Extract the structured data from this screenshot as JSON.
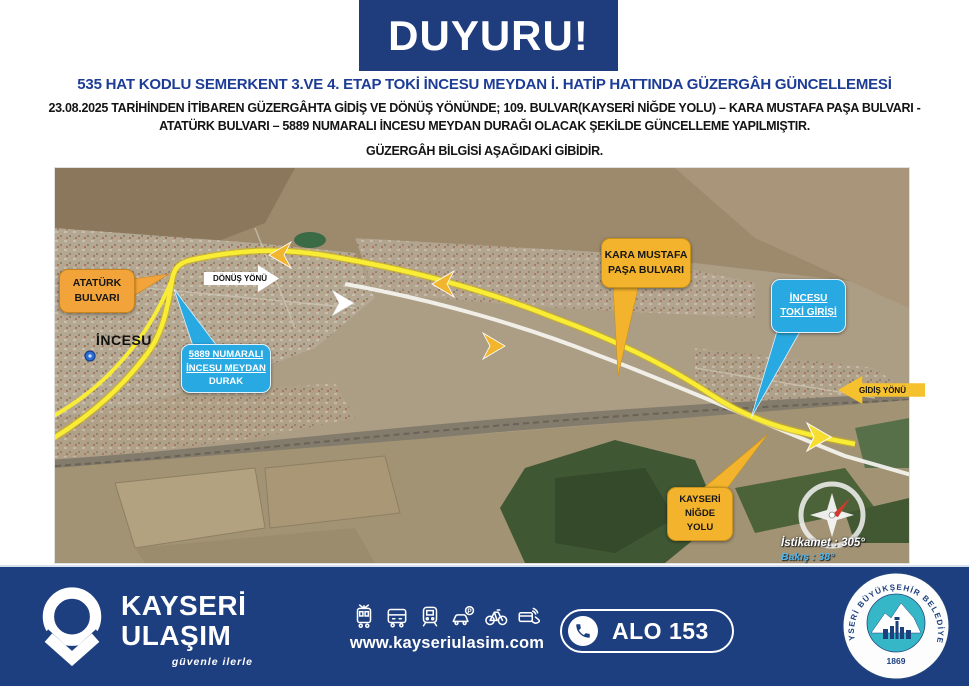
{
  "colors": {
    "primary_blue": "#1F3D7D",
    "title_blue": "#1D3C96",
    "callout_yellow": "#F3B32C",
    "callout_blue": "#29A9E1",
    "route_yellow": "#F8EC35",
    "seal_teal": "#36B7C8"
  },
  "header": {
    "banner": "DUYURU!",
    "title": "535 HAT KODLU SEMERKENT 3.VE 4. ETAP TOKİ İNCESU MEYDAN İ. HATİP HATTINDA GÜZERGÂH GÜNCELLEMESİ"
  },
  "body": {
    "line1": "23.08.2025 TARİHİNDEN İTİBAREN GÜZERGÂHTA GİDİŞ VE DÖNÜŞ YÖNÜNDE; 109. BULVAR(KAYSERİ NİĞDE YOLU) – KARA MUSTAFA PAŞA BULVARI  -",
    "line2": "ATATÜRK BULVARI – 5889 NUMARALI İNCESU MEYDAN DURAĞI OLACAK ŞEKİLDE GÜNCELLEME YAPILMIŞTIR.",
    "line3": "GÜZERGÂH BİLGİSİ AŞAĞIDAKİ GİBİDİR."
  },
  "map": {
    "ataturk": {
      "line1": "ATATÜRK",
      "line2": "BULVARI"
    },
    "donus": {
      "text": "DÖNÜŞ YÖNÜ"
    },
    "incesu": "İNCESU",
    "durak": {
      "line1": "5889 NUMARALI",
      "line2": "İNCESU MEYDAN",
      "line3": "DURAK"
    },
    "kara": {
      "line1": "KARA MUSTAFA",
      "line2": "PAŞA BULVARI"
    },
    "toki": {
      "line1": "İNCESU",
      "line2": "TOKİ GİRİŞİ"
    },
    "gidis": {
      "text": "GİDİŞ YÖNÜ"
    },
    "nigde": {
      "line1": "KAYSERİ",
      "line2": "NİĞDE",
      "line3": "YOLU"
    },
    "compass": {
      "heading": "İstikamet : 305°",
      "view": "Bakış : 38°"
    }
  },
  "footer": {
    "brand": {
      "line1": "KAYSERİ",
      "line2": "ULAŞIM",
      "tagline": "güvenle ilerle"
    },
    "icons": [
      "tram",
      "bus",
      "train",
      "car-parking",
      "bicycle",
      "smartcard"
    ],
    "website": "www.kayseriulasim.com",
    "phone_label": "ALO 153",
    "seal": {
      "ring": "KAYSERİ BÜYÜKŞEHİR BELEDİYESİ",
      "year": "1869"
    }
  }
}
